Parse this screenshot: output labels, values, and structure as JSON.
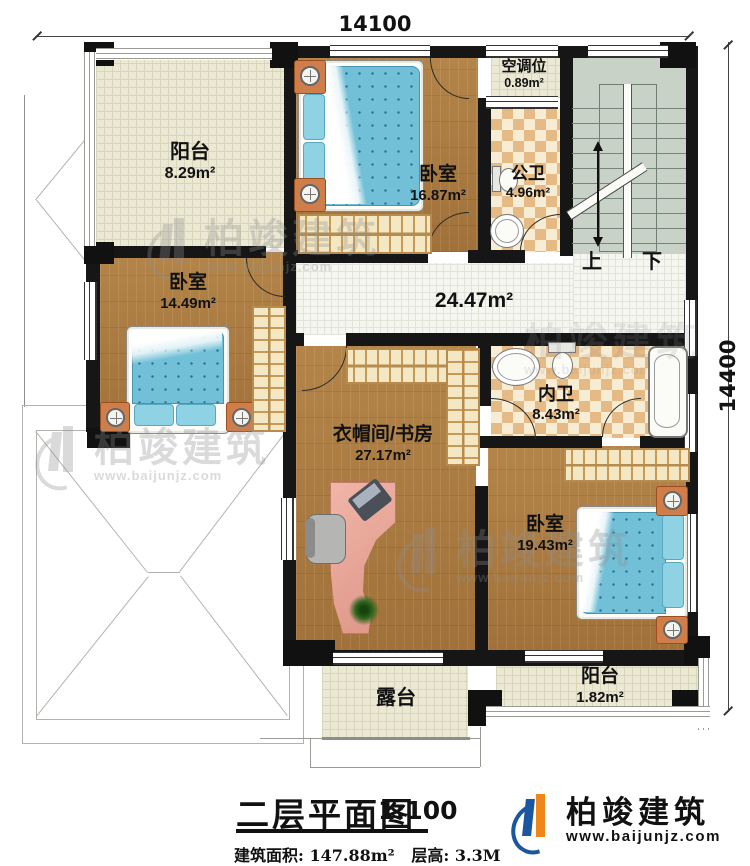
{
  "dimensions": {
    "top": "14100",
    "right": "14400"
  },
  "rooms": {
    "balcony_top": {
      "name": "阳台",
      "area": "8.29m²"
    },
    "bedroom_top": {
      "name": "卧室",
      "area": "16.87m²"
    },
    "ac_slot": {
      "name": "空调位",
      "area": "0.89m²"
    },
    "public_bath": {
      "name": "公卫",
      "area": "4.96m²"
    },
    "bedroom_left": {
      "name": "卧室",
      "area": "14.49m²"
    },
    "hallway": {
      "area": "24.47m²"
    },
    "study": {
      "name": "衣帽间/书房",
      "area": "27.17m²"
    },
    "ensuite": {
      "name": "内卫",
      "area": "8.43m²"
    },
    "bedroom_right": {
      "name": "卧室",
      "area": "19.43m²"
    },
    "terrace": {
      "name": "露台"
    },
    "balcony_bottom": {
      "name": "阳台",
      "area": "1.82m²"
    }
  },
  "stairs": {
    "up": "上",
    "down": "下"
  },
  "title_block": {
    "title": "二层平面图",
    "scale": "1:100",
    "area_label": "建筑面积:",
    "area_value": "147.88m²",
    "height_label": "层高:",
    "height_value": "3.3M"
  },
  "brand": {
    "name": "柏竣建筑",
    "url": "www.baijunjz.com"
  },
  "watermark": {
    "name": "柏竣建筑",
    "url": "www.baijunjz.com"
  },
  "colors": {
    "wall": "#161616",
    "wood": "#ab7c3e",
    "tile": "#ebe8d4",
    "stairs": "#c8d2c6",
    "bed": "#72c0d8",
    "brand_blue": "#1b56a0",
    "brand_orange": "#f08519"
  }
}
